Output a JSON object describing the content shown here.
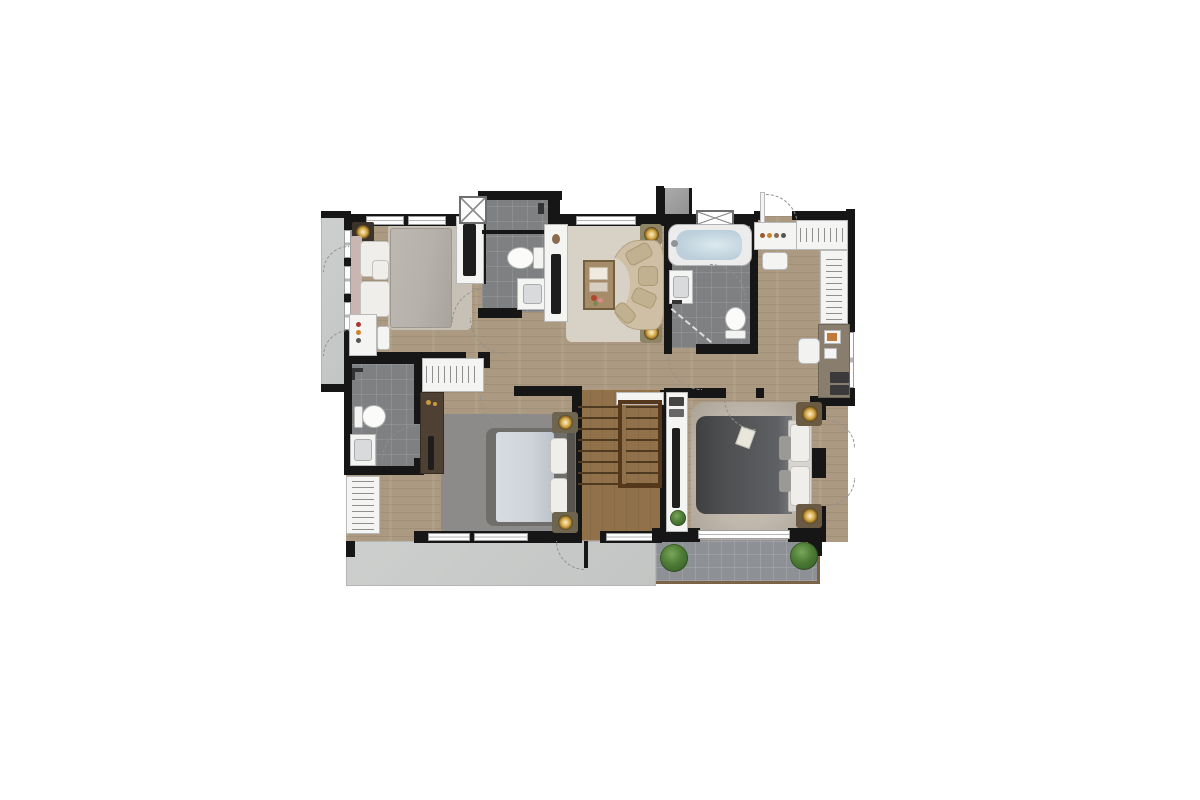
{
  "title": "second-floor-residential-floor-plan",
  "canvas": {
    "width": 1200,
    "height": 800
  },
  "palette": {
    "wall": "#161616",
    "wood": "#ab9a81",
    "stair_wood": "#91714a",
    "stair_tread": "#4e3a20",
    "tile": "#7e8082",
    "concrete": "#c9cbca",
    "balcony_tile": "#8d9094",
    "balcony_edge": "#7a6347",
    "rug_bed1": "#c7c1b5",
    "rug_living": "#d8d2c6",
    "rug_bed2": "#8c8b89",
    "rug_master": "#c0b8ad",
    "sofa": "#cfc0a5",
    "cushion": "#c2b190",
    "bed1_duvet": "#b6b1aa",
    "bed1_headboard": "#c9b6b2",
    "bed2_duvet": "#ced4da",
    "bed2_frame": "#6f6e6a",
    "master_duvet": "#4e4f51",
    "fixture_white": "#f4f4f3",
    "fixture_border": "#b9b9b9",
    "water": "#bccfda",
    "gold": "#c89b3f",
    "plant": "#3f6b2e",
    "cabinet": "#4e4134",
    "closet_taupe": "#897d6e"
  },
  "regions": [
    {
      "id": "balcony-left",
      "surface": "concrete",
      "furniture": [
        "door-swing",
        "door-swing"
      ]
    },
    {
      "id": "bedroom-top-left",
      "surface": "wood",
      "furniture": [
        "double-bed",
        "nightstand-lamp",
        "area-rug",
        "desk",
        "stool",
        "tv-console"
      ]
    },
    {
      "id": "bathroom-shared-top",
      "surface": "tile",
      "furniture": [
        "shower",
        "toilet",
        "vanity-sink",
        "shaft-window"
      ]
    },
    {
      "id": "family-area",
      "surface": "wood",
      "furniture": [
        "curved-sofa",
        "coffee-table",
        "pouf",
        "pouf",
        "tv-console"
      ]
    },
    {
      "id": "master-bathroom",
      "surface": "tile",
      "furniture": [
        "bathtub",
        "vanity-sink",
        "shower",
        "toilet"
      ]
    },
    {
      "id": "walk-in-closet",
      "surface": "wood",
      "furniture": [
        "dresser",
        "stool",
        "wardrobe-rails",
        "desk",
        "chair",
        "drawers"
      ]
    },
    {
      "id": "bathroom-left",
      "surface": "tile",
      "furniture": [
        "shower",
        "toilet",
        "vanity-sink"
      ]
    },
    {
      "id": "bedroom-middle",
      "surface": "wood",
      "furniture": [
        "double-bed",
        "nightstand-lamp",
        "nightstand-lamp",
        "area-rug",
        "wardrobe",
        "cabinet"
      ]
    },
    {
      "id": "staircase",
      "surface": "stair-wood",
      "furniture": [
        "treads",
        "railing",
        "landing"
      ]
    },
    {
      "id": "master-bedroom",
      "surface": "wood",
      "furniture": [
        "double-bed",
        "nightstand-lamp",
        "nightstand-lamp",
        "shag-rug",
        "tv-console",
        "plant"
      ]
    },
    {
      "id": "terrace-bottom",
      "surface": "concrete",
      "furniture": [
        "door-swing"
      ]
    },
    {
      "id": "balcony-bottom-right",
      "surface": "tile",
      "furniture": [
        "plant",
        "plant"
      ]
    }
  ]
}
